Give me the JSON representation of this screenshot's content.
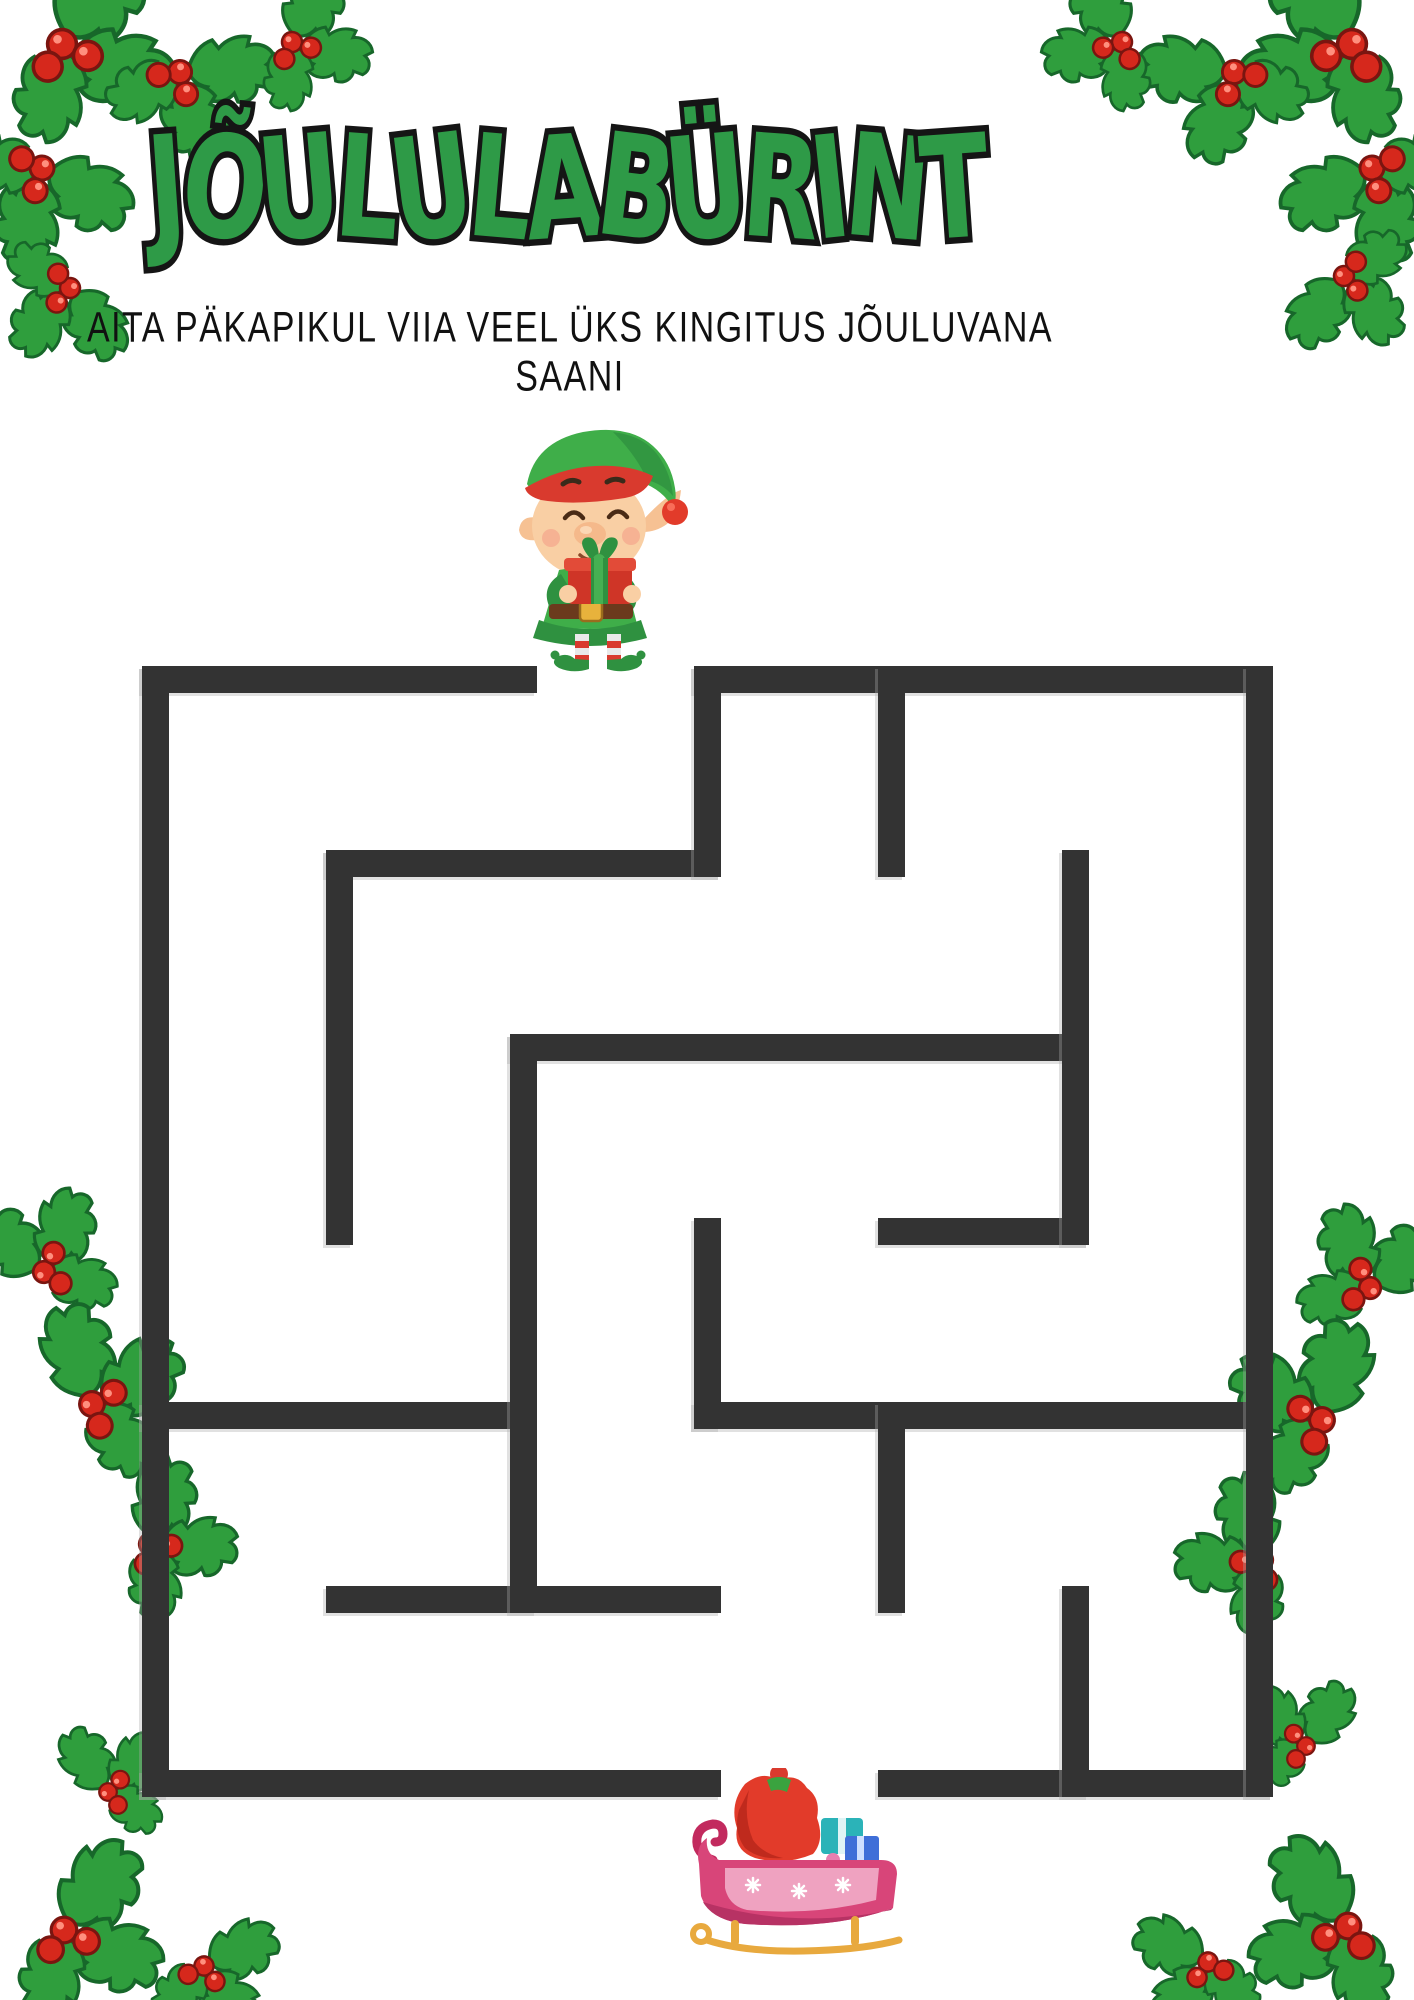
{
  "page": {
    "background": "#ffffff"
  },
  "header": {
    "title": "JÕULULABÜRINT",
    "subtitle": "AITA PÄKAPIKUL VIIA VEEL ÜKS KINGITUS JÕULUVANA SAANI",
    "title_color": "#2e9a47",
    "title_outline_color": "#151515",
    "subtitle_color": "#111111"
  },
  "maze": {
    "wall_color": "#333333",
    "grid_cols": 6,
    "grid_rows": 6,
    "origin_x": 142,
    "origin_y": 666,
    "cell_pitch": 184,
    "wall_thickness": 27,
    "entrance": {
      "side": "top",
      "col": 2
    },
    "exit": {
      "side": "bottom",
      "col": 3
    },
    "h_walls": [
      {
        "r": 0,
        "c1": 0,
        "c2": 2
      },
      {
        "r": 0,
        "c1": 3,
        "c2": 6
      },
      {
        "r": 1,
        "c1": 1,
        "c2": 3
      },
      {
        "r": 2,
        "c1": 2,
        "c2": 5
      },
      {
        "r": 3,
        "c1": 4,
        "c2": 5
      },
      {
        "r": 4,
        "c1": 0,
        "c2": 2
      },
      {
        "r": 4,
        "c1": 3,
        "c2": 6
      },
      {
        "r": 5,
        "c1": 1,
        "c2": 3
      },
      {
        "r": 6,
        "c1": 0,
        "c2": 3
      },
      {
        "r": 6,
        "c1": 4,
        "c2": 6
      }
    ],
    "v_walls": [
      {
        "c": 0,
        "r1": 0,
        "r2": 6
      },
      {
        "c": 1,
        "r1": 1,
        "r2": 3
      },
      {
        "c": 2,
        "r1": 2,
        "r2": 5
      },
      {
        "c": 3,
        "r1": 0,
        "r2": 1
      },
      {
        "c": 3,
        "r1": 3,
        "r2": 4
      },
      {
        "c": 4,
        "r1": 0,
        "r2": 1
      },
      {
        "c": 4,
        "r1": 4,
        "r2": 5
      },
      {
        "c": 5,
        "r1": 1,
        "r2": 3
      },
      {
        "c": 5,
        "r1": 5,
        "r2": 6
      },
      {
        "c": 6,
        "r1": 0,
        "r2": 6
      }
    ]
  },
  "markers": {
    "start": "elf-holding-gift",
    "goal": "santa-sleigh-with-gift-sack"
  },
  "decor": {
    "corner_decoration": "holly-leaves-with-berries",
    "holly_green": "#2f9e3d",
    "holly_dark_green": "#17672a",
    "berry_red": "#d6281c"
  }
}
